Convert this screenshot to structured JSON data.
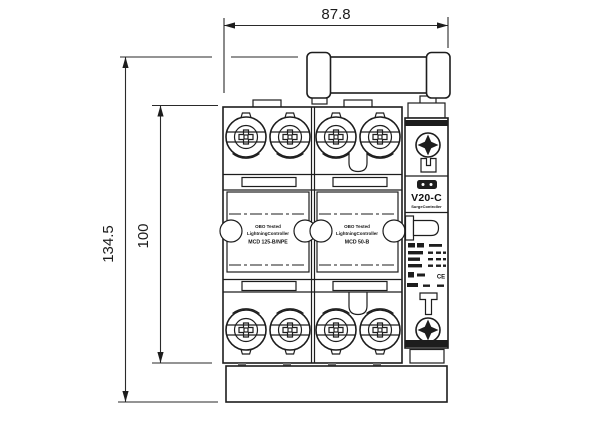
{
  "drawing": {
    "kind": "technical dimension drawing",
    "background": "#ffffff",
    "ink_color": "#1d1d1d"
  },
  "dimensions": {
    "width": "87.8",
    "height_total": "134.5",
    "height_body": "100"
  },
  "device": {
    "surge_unit": {
      "model": "V20-C",
      "type_label": "SurgeController",
      "cert_mark": "CE"
    },
    "module_left": {
      "line1": "OBO Tested",
      "line2": "LightningController",
      "line3": "MCD 125-B/NPE"
    },
    "module_right": {
      "line1": "OBO Tested",
      "line2": "LightningController",
      "line3": "MCD 50-B"
    },
    "icons": {
      "terminal_screw": "circular-clamp-combi-screw",
      "crosshead_screw": "phillips-cross-screw",
      "indicator_window": "dark-window-two-dots",
      "ratings_label": "small-print-text-block"
    }
  }
}
